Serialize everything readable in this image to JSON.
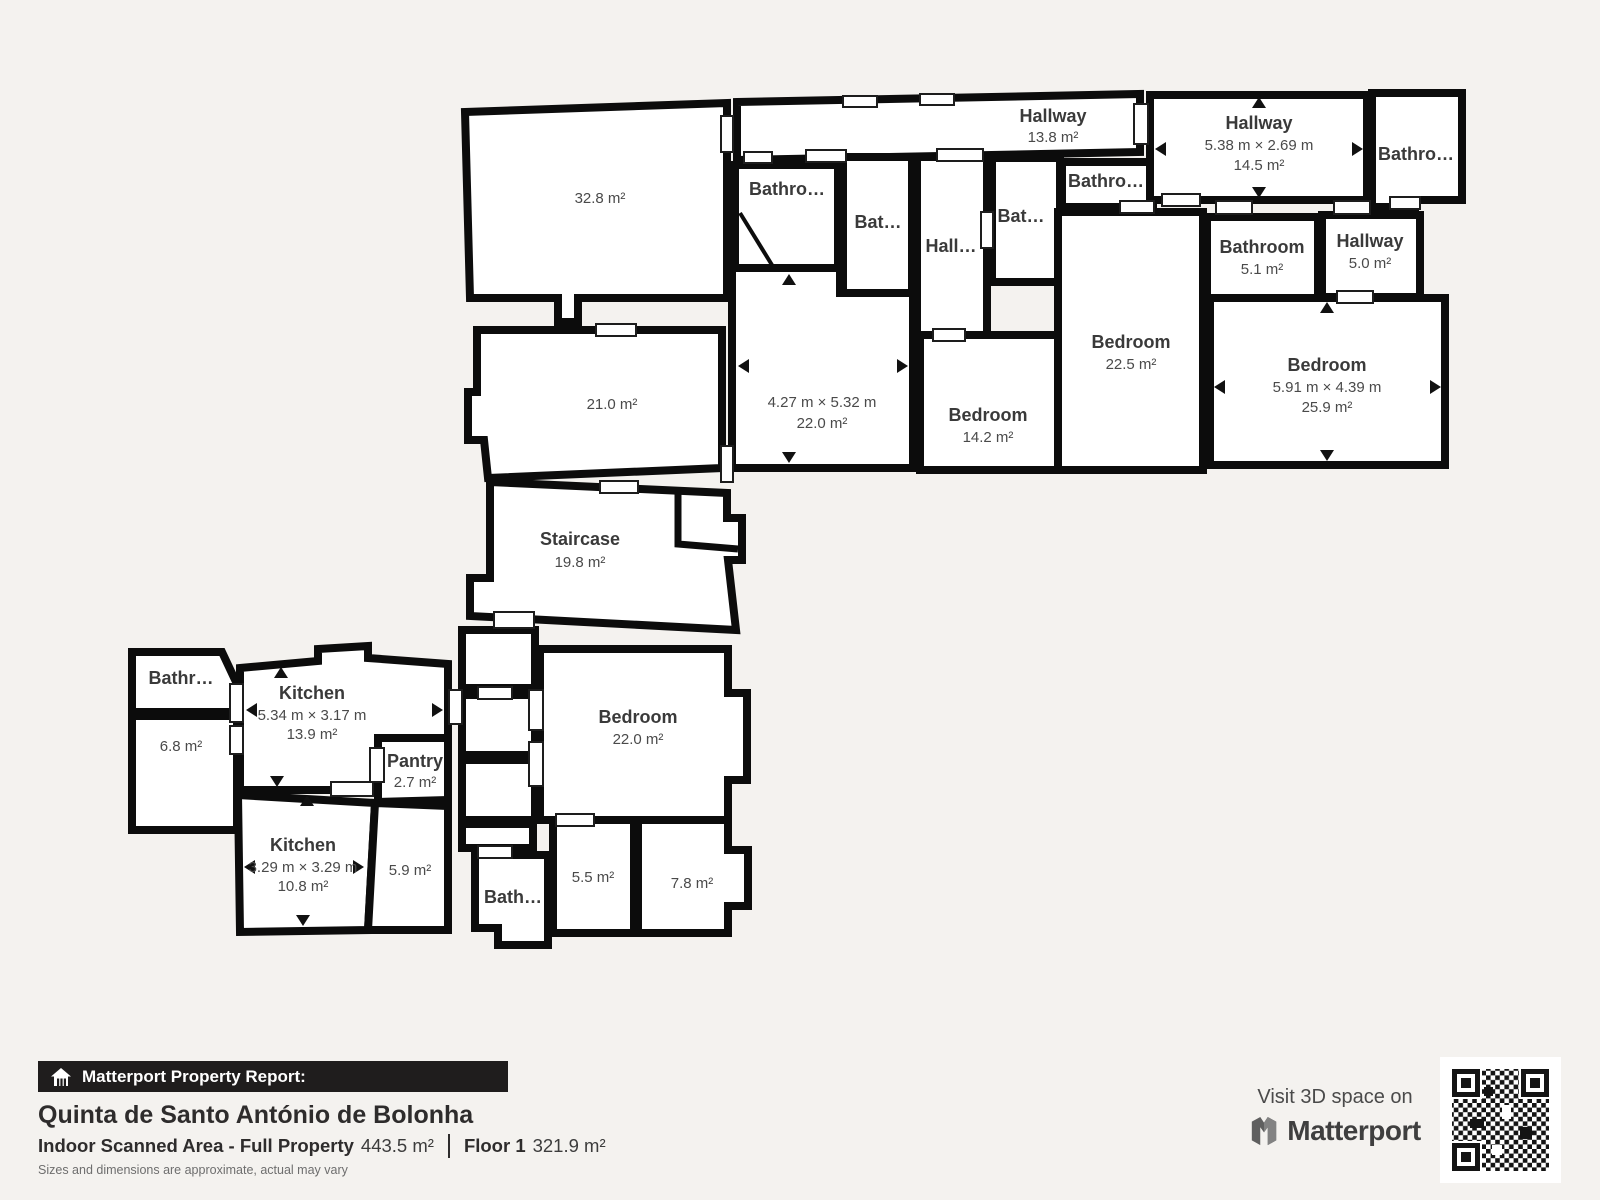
{
  "rooms": {
    "room_328": {
      "area": "32.8 m²"
    },
    "room_210": {
      "area": "21.0 m²"
    },
    "staircase": {
      "name": "Staircase",
      "area": "19.8 m²"
    },
    "hallway_top": {
      "name": "Hallway",
      "area": "13.8 m²"
    },
    "bathroom_a": {
      "name": "Bathro…"
    },
    "bathroom_b": {
      "name": "Bat…"
    },
    "hallway_mid": {
      "name": "Hall…"
    },
    "bathroom_c": {
      "name": "Bat…"
    },
    "bathroom_d": {
      "name": "Bathro…"
    },
    "room_220a": {
      "dimensions": "4.27 m × 5.32 m",
      "area": "22.0 m²"
    },
    "bedroom_142": {
      "name": "Bedroom",
      "area": "14.2 m²"
    },
    "bedroom_225": {
      "name": "Bedroom",
      "area": "22.5 m²"
    },
    "hallway_145": {
      "name": "Hallway",
      "dimensions": "5.38 m × 2.69 m",
      "area": "14.5 m²"
    },
    "bathroom_tr": {
      "name": "Bathro…"
    },
    "bathroom_51": {
      "name": "Bathroom",
      "area": "5.1 m²"
    },
    "hallway_50": {
      "name": "Hallway",
      "area": "5.0 m²"
    },
    "bedroom_259": {
      "name": "Bedroom",
      "dimensions": "5.91 m × 4.39 m",
      "area": "25.9 m²"
    },
    "bathroom_left": {
      "name": "Bathr…"
    },
    "room_68": {
      "area": "6.8 m²"
    },
    "kitchen_139": {
      "name": "Kitchen",
      "dimensions": "5.34 m × 3.17 m",
      "area": "13.9 m²"
    },
    "pantry": {
      "name": "Pantry",
      "area": "2.7 m²"
    },
    "kitchen_108": {
      "name": "Kitchen",
      "dimensions": "3.29 m × 3.29 m",
      "area": "10.8 m²"
    },
    "room_59": {
      "area": "5.9 m²"
    },
    "bathroom_bottom": {
      "name": "Bath…"
    },
    "room_55": {
      "area": "5.5 m²"
    },
    "room_78": {
      "area": "7.8 m²"
    },
    "bedroom_220b": {
      "name": "Bedroom",
      "area": "22.0 m²"
    }
  },
  "footer": {
    "report_label": "Matterport Property Report:",
    "property_name": "Quinta de Santo António de Bolonha",
    "scanned_area_label": "Indoor Scanned Area - Full Property",
    "scanned_area_value": "443.5 m²",
    "floor_label": "Floor 1",
    "floor_value": "321.9 m²",
    "disclaimer": "Sizes and dimensions are approximate, actual may vary"
  },
  "promo": {
    "visit_label": "Visit 3D space on",
    "brand_name": "Matterport"
  },
  "colors": {
    "background": "#f4f2ef",
    "wall": "#0c0c0c",
    "room_fill": "#ffffff",
    "report_bar": "#1f1d1d"
  }
}
